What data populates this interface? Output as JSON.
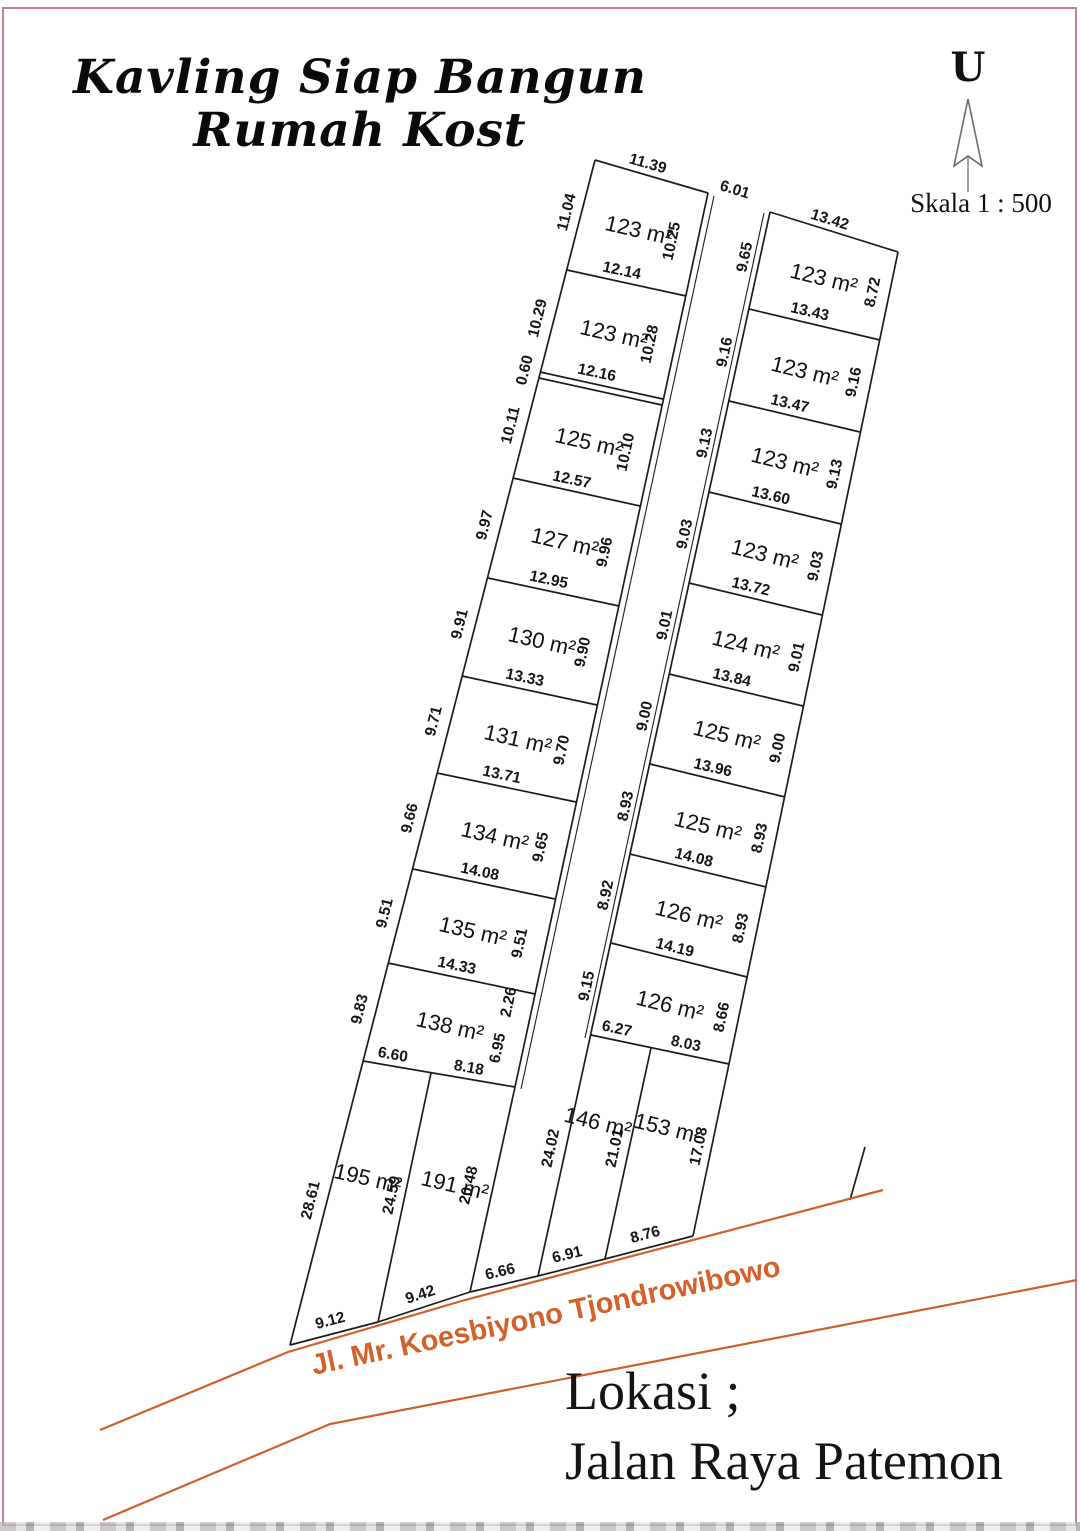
{
  "page": {
    "title_line1": "Kavling Siap Bangun",
    "title_line2": "Rumah Kost",
    "north_label": "U",
    "scale_label": "Skala 1 : 500",
    "road_label": "Jl. Mr. Koesbiyono Tjondrowibowo",
    "location_line1": "Lokasi ;",
    "location_line2": "Jalan Raya Patemon",
    "colors": {
      "line": "#1c1c1c",
      "road": "#cf5f2b",
      "border": "#c5808f",
      "road_text": "#d4612a"
    }
  },
  "diagram": {
    "segments": [
      {
        "x1": 595,
        "y1": 160,
        "x2": 708,
        "y2": 193
      },
      {
        "x1": 595,
        "y1": 160,
        "x2": 290,
        "y2": 1345
      },
      {
        "x1": 708,
        "y1": 193,
        "x2": 515,
        "y2": 1087
      },
      {
        "x1": 567,
        "y1": 270,
        "x2": 686,
        "y2": 296
      },
      {
        "x1": 540,
        "y1": 372,
        "x2": 663,
        "y2": 399
      },
      {
        "x1": 539,
        "y1": 378,
        "x2": 662,
        "y2": 405
      },
      {
        "x1": 513,
        "y1": 478,
        "x2": 640,
        "y2": 506
      },
      {
        "x1": 488,
        "y1": 578,
        "x2": 619,
        "y2": 606
      },
      {
        "x1": 462,
        "y1": 676,
        "x2": 597,
        "y2": 705
      },
      {
        "x1": 437,
        "y1": 773,
        "x2": 576,
        "y2": 802
      },
      {
        "x1": 413,
        "y1": 869,
        "x2": 555,
        "y2": 899
      },
      {
        "x1": 388,
        "y1": 963,
        "x2": 535,
        "y2": 994
      },
      {
        "x1": 363,
        "y1": 1061,
        "x2": 515,
        "y2": 1087
      },
      {
        "x1": 431,
        "y1": 1073,
        "x2": 378,
        "y2": 1322
      },
      {
        "x1": 515,
        "y1": 1087,
        "x2": 470,
        "y2": 1292
      },
      {
        "x1": 290,
        "y1": 1345,
        "x2": 378,
        "y2": 1322
      },
      {
        "x1": 378,
        "y1": 1322,
        "x2": 470,
        "y2": 1292
      },
      {
        "x1": 714,
        "y1": 196,
        "x2": 521,
        "y2": 1089,
        "w": 1.1
      },
      {
        "x1": 764,
        "y1": 213,
        "x2": 585,
        "y2": 1038,
        "w": 1.1
      },
      {
        "x1": 770,
        "y1": 212,
        "x2": 898,
        "y2": 252
      },
      {
        "x1": 770,
        "y1": 212,
        "x2": 538,
        "y2": 1276
      },
      {
        "x1": 898,
        "y1": 252,
        "x2": 729,
        "y2": 1064
      },
      {
        "x1": 749,
        "y1": 309,
        "x2": 880,
        "y2": 340
      },
      {
        "x1": 729,
        "y1": 401,
        "x2": 860,
        "y2": 432
      },
      {
        "x1": 709,
        "y1": 492,
        "x2": 841,
        "y2": 524
      },
      {
        "x1": 689,
        "y1": 583,
        "x2": 822,
        "y2": 615
      },
      {
        "x1": 669,
        "y1": 674,
        "x2": 803,
        "y2": 706
      },
      {
        "x1": 650,
        "y1": 764,
        "x2": 785,
        "y2": 797
      },
      {
        "x1": 630,
        "y1": 854,
        "x2": 766,
        "y2": 887
      },
      {
        "x1": 611,
        "y1": 943,
        "x2": 747,
        "y2": 977
      },
      {
        "x1": 591,
        "y1": 1035,
        "x2": 729,
        "y2": 1064
      },
      {
        "x1": 651,
        "y1": 1048,
        "x2": 605,
        "y2": 1259
      },
      {
        "x1": 729,
        "y1": 1064,
        "x2": 693,
        "y2": 1236
      },
      {
        "x1": 538,
        "y1": 1276,
        "x2": 605,
        "y2": 1259
      },
      {
        "x1": 605,
        "y1": 1259,
        "x2": 693,
        "y2": 1236
      },
      {
        "x1": 470,
        "y1": 1292,
        "x2": 538,
        "y2": 1276
      },
      {
        "x1": 865,
        "y1": 1147,
        "x2": 850,
        "y2": 1200
      }
    ],
    "roads": [
      {
        "points": "883,1190 465,1300 288,1352 100,1430"
      },
      {
        "points": "1077,1280 330,1424 103,1520"
      }
    ],
    "labels": [
      {
        "t": "11.39",
        "x": 648,
        "y": 163,
        "r": 16,
        "k": "dim"
      },
      {
        "t": "6.01",
        "x": 735,
        "y": 189,
        "r": 17,
        "k": "dim"
      },
      {
        "t": "13.42",
        "x": 830,
        "y": 219,
        "r": 17,
        "k": "dim"
      },
      {
        "t": "11.04",
        "x": 566,
        "y": 212,
        "r": -76,
        "k": "dim"
      },
      {
        "t": "10.29",
        "x": 537,
        "y": 318,
        "r": -76,
        "k": "dim"
      },
      {
        "t": "0.60",
        "x": 524,
        "y": 370,
        "r": -76,
        "k": "dim"
      },
      {
        "t": "10.11",
        "x": 510,
        "y": 425,
        "r": -76,
        "k": "dim"
      },
      {
        "t": "9.97",
        "x": 484,
        "y": 525,
        "r": -76,
        "k": "dim"
      },
      {
        "t": "9.91",
        "x": 459,
        "y": 624,
        "r": -76,
        "k": "dim"
      },
      {
        "t": "9.71",
        "x": 433,
        "y": 721,
        "r": -76,
        "k": "dim"
      },
      {
        "t": "9.66",
        "x": 409,
        "y": 818,
        "r": -76,
        "k": "dim"
      },
      {
        "t": "9.51",
        "x": 384,
        "y": 913,
        "r": -76,
        "k": "dim"
      },
      {
        "t": "9.83",
        "x": 359,
        "y": 1009,
        "r": -76,
        "k": "dim"
      },
      {
        "t": "28.61",
        "x": 310,
        "y": 1200,
        "r": -76,
        "k": "dim"
      },
      {
        "t": "10.25",
        "x": 671,
        "y": 241,
        "r": -78,
        "k": "dim"
      },
      {
        "t": "10.28",
        "x": 649,
        "y": 344,
        "r": -78,
        "k": "dim"
      },
      {
        "t": "10.10",
        "x": 625,
        "y": 452,
        "r": -78,
        "k": "dim"
      },
      {
        "t": "9.96",
        "x": 604,
        "y": 552,
        "r": -78,
        "k": "dim"
      },
      {
        "t": "9.90",
        "x": 582,
        "y": 652,
        "r": -78,
        "k": "dim"
      },
      {
        "t": "9.70",
        "x": 561,
        "y": 750,
        "r": -78,
        "k": "dim"
      },
      {
        "t": "9.65",
        "x": 540,
        "y": 847,
        "r": -78,
        "k": "dim"
      },
      {
        "t": "9.51",
        "x": 519,
        "y": 943,
        "r": -78,
        "k": "dim"
      },
      {
        "t": "2.26",
        "x": 508,
        "y": 1002,
        "r": -78,
        "k": "dim"
      },
      {
        "t": "6.95",
        "x": 497,
        "y": 1048,
        "r": -78,
        "k": "dim"
      },
      {
        "t": "20.48",
        "x": 468,
        "y": 1185,
        "r": -77,
        "k": "dim"
      },
      {
        "t": "24.59",
        "x": 391,
        "y": 1195,
        "r": -78,
        "k": "dim"
      },
      {
        "t": "12.14",
        "x": 622,
        "y": 270,
        "r": 12,
        "k": "dim"
      },
      {
        "t": "12.16",
        "x": 597,
        "y": 372,
        "r": 12,
        "k": "dim"
      },
      {
        "t": "12.57",
        "x": 572,
        "y": 479,
        "r": 12,
        "k": "dim"
      },
      {
        "t": "12.95",
        "x": 549,
        "y": 579,
        "r": 12,
        "k": "dim"
      },
      {
        "t": "13.33",
        "x": 525,
        "y": 677,
        "r": 12,
        "k": "dim"
      },
      {
        "t": "13.71",
        "x": 502,
        "y": 774,
        "r": 12,
        "k": "dim"
      },
      {
        "t": "14.08",
        "x": 480,
        "y": 871,
        "r": 12,
        "k": "dim"
      },
      {
        "t": "14.33",
        "x": 457,
        "y": 965,
        "r": 12,
        "k": "dim"
      },
      {
        "t": "6.60",
        "x": 393,
        "y": 1054,
        "r": 10,
        "k": "dim"
      },
      {
        "t": "8.18",
        "x": 469,
        "y": 1067,
        "r": 10,
        "k": "dim"
      },
      {
        "t": "9.65",
        "x": 744,
        "y": 257,
        "r": -78,
        "k": "dim"
      },
      {
        "t": "9.16",
        "x": 724,
        "y": 352,
        "r": -78,
        "k": "dim"
      },
      {
        "t": "9.13",
        "x": 704,
        "y": 443,
        "r": -78,
        "k": "dim"
      },
      {
        "t": "9.03",
        "x": 684,
        "y": 534,
        "r": -78,
        "k": "dim"
      },
      {
        "t": "9.01",
        "x": 664,
        "y": 625,
        "r": -78,
        "k": "dim"
      },
      {
        "t": "9.00",
        "x": 644,
        "y": 716,
        "r": -78,
        "k": "dim"
      },
      {
        "t": "8.93",
        "x": 625,
        "y": 806,
        "r": -78,
        "k": "dim"
      },
      {
        "t": "8.92",
        "x": 605,
        "y": 895,
        "r": -78,
        "k": "dim"
      },
      {
        "t": "9.15",
        "x": 586,
        "y": 986,
        "r": -78,
        "k": "dim"
      },
      {
        "t": "24.02",
        "x": 550,
        "y": 1148,
        "r": -78,
        "k": "dim"
      },
      {
        "t": "8.72",
        "x": 872,
        "y": 292,
        "r": -78,
        "k": "dim"
      },
      {
        "t": "9.16",
        "x": 853,
        "y": 382,
        "r": -78,
        "k": "dim"
      },
      {
        "t": "9.13",
        "x": 834,
        "y": 474,
        "r": -78,
        "k": "dim"
      },
      {
        "t": "9.03",
        "x": 815,
        "y": 566,
        "r": -78,
        "k": "dim"
      },
      {
        "t": "9.01",
        "x": 796,
        "y": 657,
        "r": -78,
        "k": "dim"
      },
      {
        "t": "9.00",
        "x": 777,
        "y": 748,
        "r": -78,
        "k": "dim"
      },
      {
        "t": "8.93",
        "x": 759,
        "y": 838,
        "r": -78,
        "k": "dim"
      },
      {
        "t": "8.93",
        "x": 740,
        "y": 928,
        "r": -78,
        "k": "dim"
      },
      {
        "t": "8.66",
        "x": 721,
        "y": 1017,
        "r": -78,
        "k": "dim"
      },
      {
        "t": "17.08",
        "x": 698,
        "y": 1146,
        "r": -78,
        "k": "dim"
      },
      {
        "t": "21.01",
        "x": 614,
        "y": 1148,
        "r": -78,
        "k": "dim"
      },
      {
        "t": "13.43",
        "x": 810,
        "y": 311,
        "r": 13,
        "k": "dim"
      },
      {
        "t": "13.47",
        "x": 790,
        "y": 403,
        "r": 13,
        "k": "dim"
      },
      {
        "t": "13.60",
        "x": 771,
        "y": 495,
        "r": 13,
        "k": "dim"
      },
      {
        "t": "13.72",
        "x": 751,
        "y": 586,
        "r": 13,
        "k": "dim"
      },
      {
        "t": "13.84",
        "x": 732,
        "y": 677,
        "r": 13,
        "k": "dim"
      },
      {
        "t": "13.96",
        "x": 713,
        "y": 767,
        "r": 13,
        "k": "dim"
      },
      {
        "t": "14.08",
        "x": 694,
        "y": 857,
        "r": 14,
        "k": "dim"
      },
      {
        "t": "14.19",
        "x": 675,
        "y": 947,
        "r": 14,
        "k": "dim"
      },
      {
        "t": "6.27",
        "x": 617,
        "y": 1028,
        "r": 12,
        "k": "dim"
      },
      {
        "t": "8.03",
        "x": 686,
        "y": 1043,
        "r": 12,
        "k": "dim"
      },
      {
        "t": "9.12",
        "x": 330,
        "y": 1320,
        "r": -15,
        "k": "dim"
      },
      {
        "t": "9.42",
        "x": 420,
        "y": 1294,
        "r": -18,
        "k": "dim"
      },
      {
        "t": "6.66",
        "x": 500,
        "y": 1271,
        "r": -13,
        "k": "dim"
      },
      {
        "t": "6.91",
        "x": 567,
        "y": 1254,
        "r": -14,
        "k": "dim"
      },
      {
        "t": "8.76",
        "x": 645,
        "y": 1234,
        "r": -15,
        "k": "dim"
      },
      {
        "t": "123 m²",
        "x": 639,
        "y": 230,
        "r": 13,
        "k": "area"
      },
      {
        "t": "123 m²",
        "x": 614,
        "y": 334,
        "r": 13,
        "k": "area"
      },
      {
        "t": "125 m²",
        "x": 589,
        "y": 442,
        "r": 13,
        "k": "area"
      },
      {
        "t": "127 m²",
        "x": 565,
        "y": 542,
        "r": 13,
        "k": "area"
      },
      {
        "t": "130 m²",
        "x": 542,
        "y": 641,
        "r": 13,
        "k": "area"
      },
      {
        "t": "131 m²",
        "x": 518,
        "y": 739,
        "r": 13,
        "k": "area"
      },
      {
        "t": "134 m²",
        "x": 495,
        "y": 836,
        "r": 13,
        "k": "area"
      },
      {
        "t": "135 m²",
        "x": 473,
        "y": 931,
        "r": 13,
        "k": "area"
      },
      {
        "t": "138 m²",
        "x": 450,
        "y": 1026,
        "r": 13,
        "k": "area"
      },
      {
        "t": "195 m²",
        "x": 368,
        "y": 1178,
        "r": 13,
        "k": "area"
      },
      {
        "t": "191 m²",
        "x": 455,
        "y": 1185,
        "r": 13,
        "k": "area"
      },
      {
        "t": "123 m²",
        "x": 824,
        "y": 278,
        "r": 14,
        "k": "area"
      },
      {
        "t": "123 m²",
        "x": 805,
        "y": 371,
        "r": 14,
        "k": "area"
      },
      {
        "t": "123 m²",
        "x": 785,
        "y": 462,
        "r": 14,
        "k": "area"
      },
      {
        "t": "123 m²",
        "x": 765,
        "y": 554,
        "r": 14,
        "k": "area"
      },
      {
        "t": "124 m²",
        "x": 746,
        "y": 645,
        "r": 14,
        "k": "area"
      },
      {
        "t": "125 m²",
        "x": 727,
        "y": 735,
        "r": 14,
        "k": "area"
      },
      {
        "t": "125 m²",
        "x": 708,
        "y": 826,
        "r": 14,
        "k": "area"
      },
      {
        "t": "126 m²",
        "x": 689,
        "y": 915,
        "r": 14,
        "k": "area"
      },
      {
        "t": "126 m²",
        "x": 670,
        "y": 1005,
        "r": 14,
        "k": "area"
      },
      {
        "t": "146 m²",
        "x": 598,
        "y": 1122,
        "r": 14,
        "k": "area",
        "s": 20
      },
      {
        "t": "153 m²",
        "x": 668,
        "y": 1128,
        "r": 14,
        "k": "area",
        "s": 20
      }
    ]
  }
}
